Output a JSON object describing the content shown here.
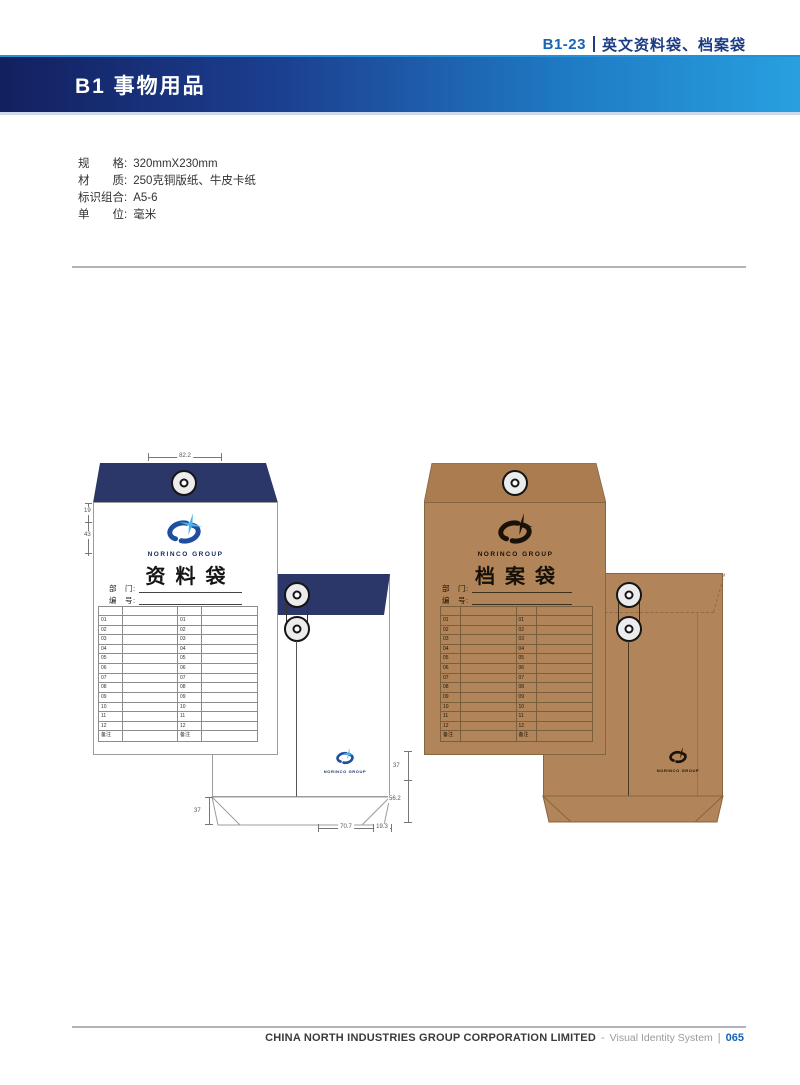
{
  "page": {
    "header_code": "B1-23",
    "header_title": "英文资料袋、档案袋",
    "section_title": "B1 事物用品",
    "footer_company": "CHINA NORTH INDUSTRIES GROUP CORPORATION LIMITED",
    "footer_separator": "-",
    "footer_system": "Visual Identity System",
    "footer_divider": "|",
    "footer_page": "065"
  },
  "specs": {
    "rows": [
      {
        "label": "规　　格:",
        "value": "320mmX230mm"
      },
      {
        "label": "材　　质:",
        "value": "250克铜版纸、牛皮卡纸"
      },
      {
        "label": "标识组合:",
        "value": "A5-6"
      },
      {
        "label": "单　　位:",
        "value": "毫米"
      }
    ]
  },
  "envelopes": {
    "brand": "NORINCO GROUP",
    "doc_bag_title": "资料袋",
    "archive_bag_title": "档案袋",
    "dept_label": "部　门:",
    "no_label": "编　号:",
    "table_row_labels": [
      "01",
      "02",
      "03",
      "04",
      "05",
      "06",
      "07",
      "08",
      "09",
      "10",
      "11",
      "12",
      "备注"
    ]
  },
  "dimensions": {
    "top_width": "82.2",
    "left_upper": "19",
    "left_lower": "43",
    "flap_left": "37",
    "right_upper": "37",
    "right_lower": "56.2",
    "bottom_center": "70.7",
    "bottom_right": "19.3"
  },
  "colors": {
    "accent": "#1464b8",
    "header_title": "#1b3c85",
    "navy": "#2a3768",
    "kraft": "#b28459",
    "kraft_flap": "#aa7c50",
    "kraft_border": "#86663f",
    "logo_blue": "#1d4f9e",
    "logo_spark": "#49b2e8",
    "bar_dark": "#13205f",
    "bar_light": "#28a0e0"
  }
}
